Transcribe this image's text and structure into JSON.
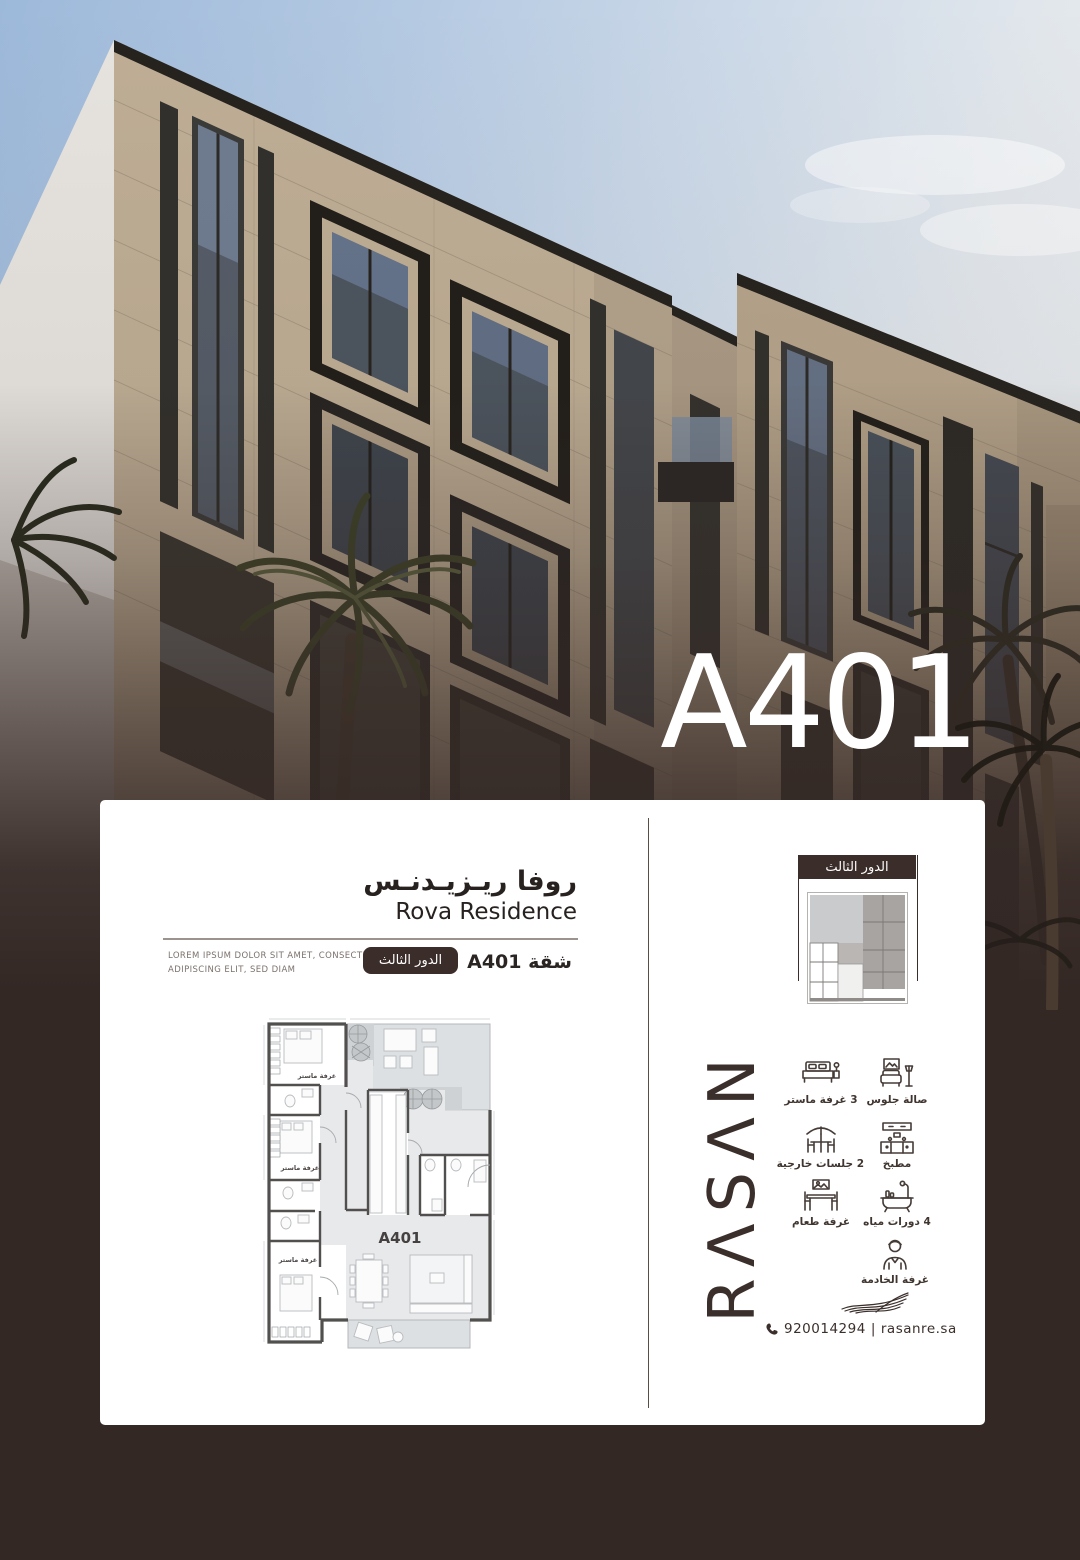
{
  "colors": {
    "accent_dark_brown": "#3b2d2a",
    "background_brown": "#342825",
    "facade_beige": "#bfae95",
    "sky_blue": "#b4c9e2"
  },
  "hero": {
    "unit_overlay": "A401"
  },
  "card": {
    "title_ar": "روفا ريـزيـدنـس",
    "title_en": "Rova Residence",
    "description_line1": "LOREM IPSUM DOLOR SIT AMET, CONSECTETUER",
    "description_line2": "ADIPISCING ELIT, SED DIAM",
    "floor_badge": "الدور الثالث",
    "unit_label": "شقة A401",
    "floorplan": {
      "unit": "A401",
      "master_bedroom": "غرفة ماستر"
    },
    "sidebar": {
      "floor_header": "الدور الثالث",
      "brand": "RΛSΛN",
      "features": [
        {
          "icon": "bed-icon",
          "label": "3 غرفة ماستر"
        },
        {
          "icon": "sofa-icon",
          "label": "صالة جلوس"
        },
        {
          "icon": "umbrella-icon",
          "label": "2 جلسات خارجية"
        },
        {
          "icon": "kitchen-icon",
          "label": "مطبخ"
        },
        {
          "icon": "dining-icon",
          "label": "غرفة طعام"
        },
        {
          "icon": "bath-icon",
          "label": "4 دورات مياه"
        },
        {
          "icon": "maid-icon",
          "label": "غرفة الخادمة"
        }
      ],
      "contact": {
        "phone": "920014294",
        "separator": "|",
        "website": "rasanre.sa"
      }
    }
  }
}
